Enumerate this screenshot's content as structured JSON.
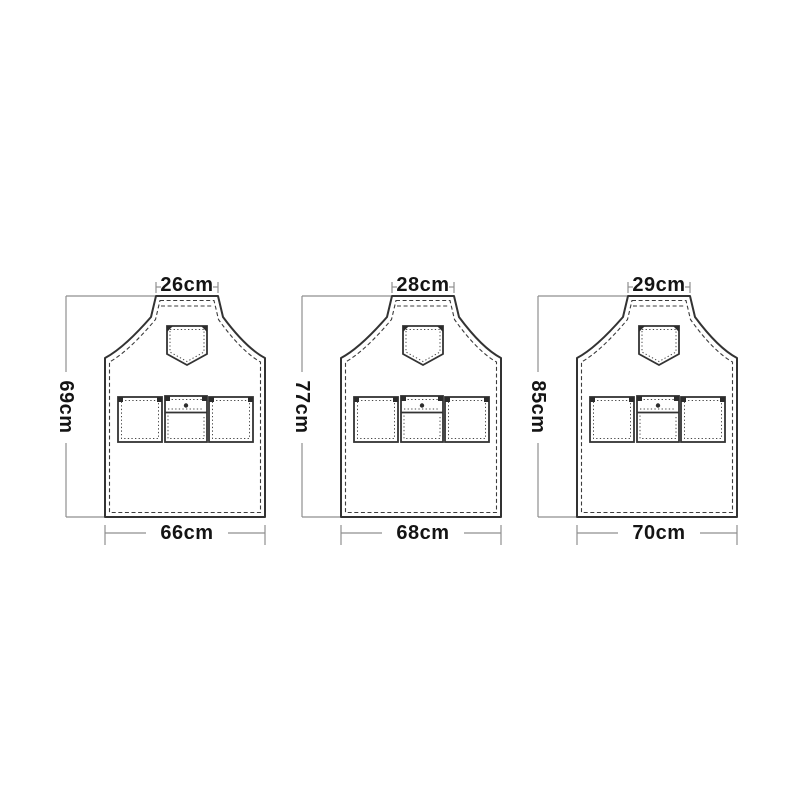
{
  "figure": {
    "kind": "apron-size-specification-diagram",
    "background": "#ffffff",
    "colors": {
      "outline": "#333333",
      "stitching": "#3c3c3c",
      "dimension_lines": "#8f8f8f",
      "label_text": "#141414"
    }
  },
  "aprons": [
    {
      "top_width": "26cm",
      "height": "69cm",
      "bottom_width": "66cm"
    },
    {
      "top_width": "28cm",
      "height": "77cm",
      "bottom_width": "68cm"
    },
    {
      "top_width": "29cm",
      "height": "85cm",
      "bottom_width": "70cm"
    }
  ]
}
